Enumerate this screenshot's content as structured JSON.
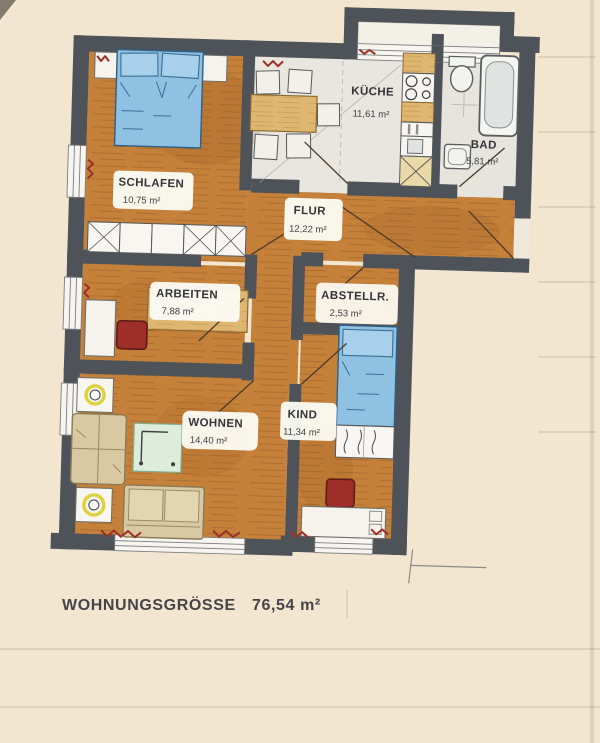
{
  "title": "Grundriss Wohnung",
  "footer": {
    "label": "WOHNUNGSGRÖSSE",
    "value": "76,54 m²"
  },
  "rooms": [
    {
      "id": "schlafen",
      "name": "SCHLAFEN",
      "area": "10,75 m²"
    },
    {
      "id": "kueche",
      "name": "KÜCHE",
      "area": "11,61 m²"
    },
    {
      "id": "bad",
      "name": "BAD",
      "area": "5,81 m²"
    },
    {
      "id": "flur",
      "name": "FLUR",
      "area": "12,22 m²"
    },
    {
      "id": "arbeiten",
      "name": "ARBEITEN",
      "area": "7,88 m²"
    },
    {
      "id": "abstellraum",
      "name": "ABSTELLR.",
      "area": "2,53 m²"
    },
    {
      "id": "wohnen",
      "name": "WOHNEN",
      "area": "14,40 m²"
    },
    {
      "id": "kind",
      "name": "KIND",
      "area": "11,34 m²"
    }
  ],
  "furniture": {
    "schlafen": [
      "double-bed",
      "nightstand-left",
      "nightstand-right",
      "wardrobe-row"
    ],
    "kueche": [
      "dining-table",
      "chairs",
      "kitchen-counter",
      "stove",
      "utensil-rack",
      "kitchen-sink",
      "tall-cabinet"
    ],
    "bad": [
      "toilet",
      "bathtub",
      "washbasin"
    ],
    "arbeiten": [
      "desk",
      "office-chair",
      "cabinet"
    ],
    "wohnen": [
      "side-table-lamp",
      "armchair",
      "side-table-lamp",
      "glass-coffee-table",
      "sofa"
    ],
    "kind": [
      "single-bed",
      "wardrobe",
      "office-chair",
      "desk"
    ],
    "misc": [
      "radiators",
      "windows",
      "door-swings",
      "entrance-door"
    ]
  },
  "colors": {
    "paper": "#f2e6d0",
    "wall": "#4e535a",
    "floor_wood": "#c5803a",
    "floor_wood_streak": "#8d5a22",
    "floor_light": "#e9e6df",
    "bed_blue": "#8fc2e2",
    "wood_light": "#dfb671",
    "furniture_beige": "#d8c9a3",
    "accent_red": "#9e2f28",
    "glass_green": "#ddecdb",
    "lamp_yellow": "#ddd23e",
    "label_bg": "#fcfcf6",
    "text": "#33343a"
  }
}
